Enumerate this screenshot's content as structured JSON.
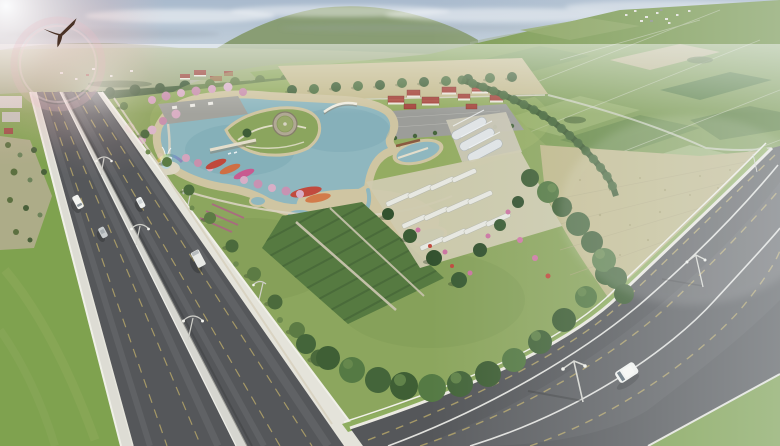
{
  "scene": {
    "title": "Aerial architectural rendering of a landscaped park",
    "description": "Bird's-eye 3D visualization of a triangular park wedged between a divided highway (left) and a rural arterial road (bottom right), surrounded by patchwork farm fields, with a hazy town on the horizon and a lens flare with a soaring bird at top left",
    "time_of_day": "daytime, hazy sun from upper left",
    "style": "photorealistic masterplan rendering"
  },
  "palette": {
    "sky": "#b4c3d2",
    "haze": "#e9eef1",
    "hills": "#84996b",
    "plain": "#9aa87e",
    "fields_base": "#7f9d55",
    "field_light": "#a3b87d",
    "field_dark": "#5d7f41",
    "field_tan": "#c0b98b",
    "forest": "#44603a",
    "park_grass": "#8ca65e",
    "lake": "#8fb7bf",
    "lake_deep": "#74a2ae",
    "sand": "#cfc5a2",
    "path": "#d9d3c1",
    "cherry_pink": "#d5a8c0",
    "flower_red": "#c0483c",
    "flower_pink": "#d2689a",
    "hedge": "#567a41",
    "conifer": "#33522f",
    "bed_white": "#e7e8e1",
    "roof_red": "#a5453c",
    "wall_white": "#e9e5da",
    "parking": "#9c9d99",
    "greenhouse": "#e0e4e6",
    "asphalt": "#55575a",
    "asphalt_light": "#6b6d70",
    "lane_yellow": "#b3a469",
    "line_white": "#e9e9e5",
    "barrier": "#d6d6d0",
    "verge_grass": "#7fa24f",
    "bird": "#4a3226",
    "flare_pink": "#eec6c6",
    "rainbow": [
      "#e05050",
      "#e0a050",
      "#e8d860",
      "#70b060",
      "#6080c8",
      "#9060b0"
    ]
  },
  "objects": {
    "bird": {
      "type": "soaring bird of prey silhouette",
      "position": "top-left sky near lens flare"
    },
    "lens_flare": {
      "position": "top-left corner",
      "elements": [
        "bright glow",
        "pink ring",
        "sparkle spots"
      ]
    },
    "vehicles": {
      "highway": [
        "white van southbound",
        "white car northbound",
        "silver car southbound",
        "white box truck northbound"
      ],
      "side_road": [
        "white minivan heading southwest"
      ]
    },
    "park_features": [
      "curved lake with green island",
      "round stone rotunda with grass roof",
      "arched white footbridge",
      "flat footbridge with small weir",
      "fountain with rainbow mist",
      "rows of pink cherry-blossom trees",
      "red and pink flower parterres",
      "hedge crop plots",
      "white raised planting beds",
      "conifer allee",
      "red-roofed visitor village with parking lot",
      "white greenhouse tunnels",
      "tree-lined promenade along highway",
      "dense tree belt along south edge",
      "tilled tan field on east side"
    ],
    "surroundings": [
      "six-lane divided highway with median barrier and street lights",
      "wide rural road with yellow lane lines",
      "patchwork crop fields",
      "distant town and farmsteads",
      "hazy green hills"
    ]
  }
}
